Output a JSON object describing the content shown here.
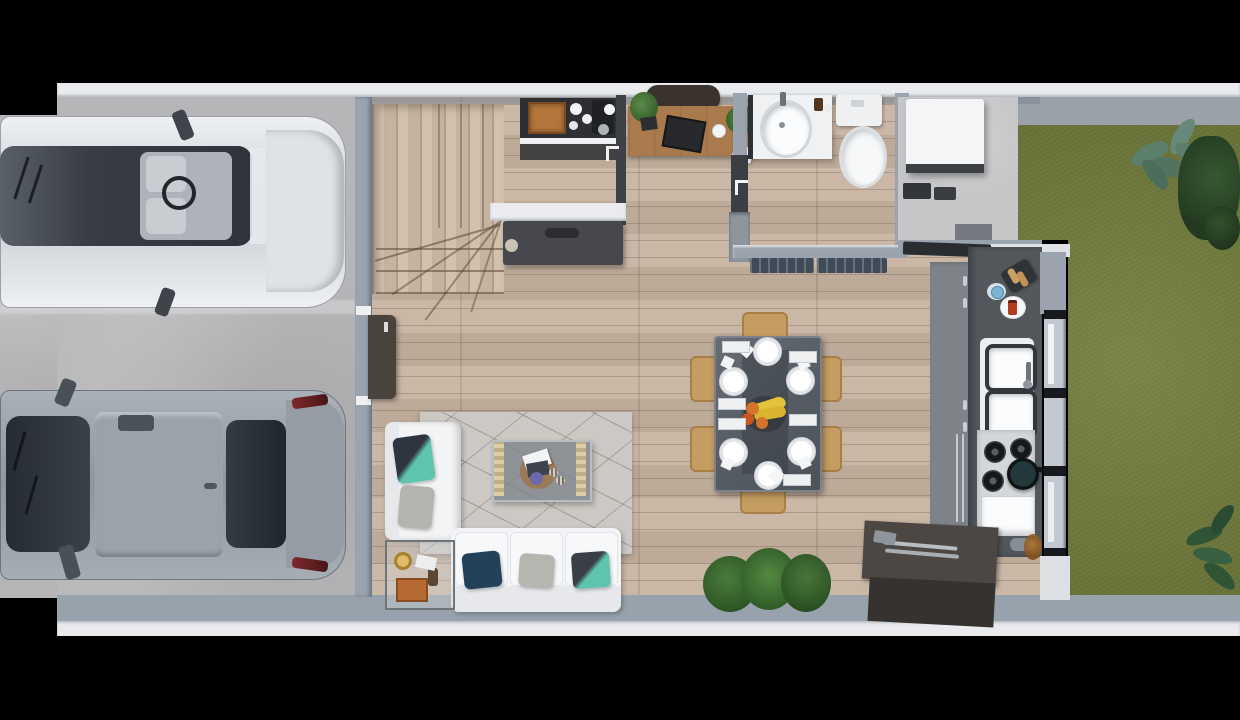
{
  "scene": {
    "title": "Top-down 3D architectural render of a ground floor: double driveway with two SUVs, entry with winder stairs, home office nook, bathroom, open-plan living and dining, galley kitchen, utility pad and backyard lawn",
    "render_style": "photoreal top-down 3D floor plan on black background",
    "palette": {
      "background": "#000000",
      "outer_wall_white": "#e9ebee",
      "wall_gray": "#9aa3ae",
      "concrete": "#b6b5b7",
      "wood_floor": "#c7b3a1",
      "stair_wood": "#d0bda8",
      "lawn_green": "#75803e",
      "bush_dark_green": "#2c472e",
      "fern_gray_green": "#5c7f6b",
      "counter_dark": "#53575c",
      "cabinet_gray": "#7e838a",
      "island_dark": "#4c4743",
      "sofa_white": "#f3f4f6",
      "rug_gray": "#ccc8c3",
      "pillow_navy": "#24415c",
      "pillow_teal": "#5ec4ae",
      "dining_chair_tan": "#c59c62",
      "dining_table_gray": "#5b6168",
      "desk_wood": "#a87a4c",
      "door_dark": "#4a433d",
      "car_silver": "#dfe3e7",
      "car_gray": "#9aa2aa",
      "banana_yellow": "#e3c23c",
      "orange_fruit": "#d2742a"
    },
    "areas": {
      "driveway": {
        "label": "Concrete driveway with two parking bays"
      },
      "car_silver": {
        "label": "Silver SUV parked in upper bay, dark panoramic glass roof, gray seats and steering wheel visible"
      },
      "car_gray": {
        "label": "Gray SUV parked in lower bay with dark windshield and red taillights"
      },
      "garage_door": {
        "label": "Dark side-entry door from driveway into living room"
      },
      "stairs": {
        "label": "Wood winder staircase to upper floor"
      },
      "coffee_station": {
        "label": "Coffee station: wooden box, espresso machine and white cups on dark counter"
      },
      "media_console": {
        "label": "Dark media console with round knob"
      },
      "office": {
        "label": "Home office: wood desk, dark chair, laptop, mug and two plants"
      },
      "bathroom": {
        "label": "Bathroom with white vanity sink and toilet, two dark mats at the door"
      },
      "utility": {
        "label": "Utility pad with white appliance and storage boxes"
      },
      "kitchen": {
        "label": "Galley kitchen: dark counter with toaster, double sink, gas cooktop with pan, oven, towel rails and island with utensils"
      },
      "dining": {
        "label": "Glass dining table, six white place settings, six tan chairs, fruit bowl with bananas and oranges"
      },
      "living": {
        "label": "Living room: white L-shaped sofa with navy, gray and teal pillows, geometric rug, coffee table with tray, corner side table with lamp"
      },
      "backyard": {
        "label": "Backyard lawn with dark shrubs, gray-green fern and corner fern"
      },
      "indoor_plant": {
        "label": "Bushy green indoor plant at the bottom wall"
      },
      "windows": {
        "label": "Kitchen window strip with black frames facing the lawn"
      }
    }
  }
}
